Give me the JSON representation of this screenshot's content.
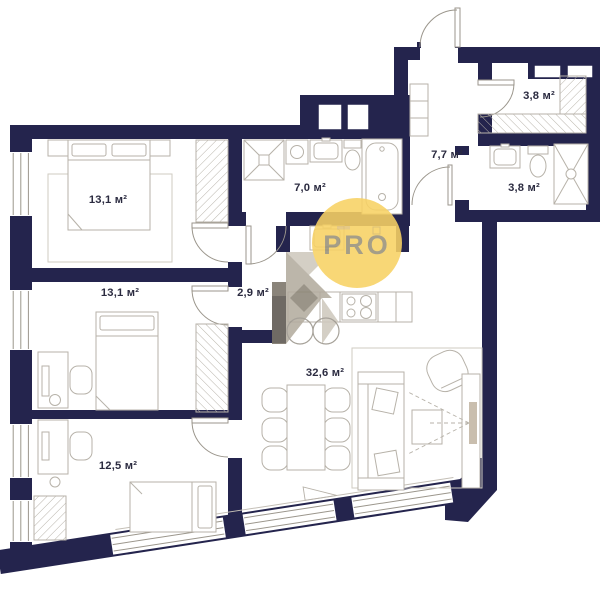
{
  "plan": {
    "type": "apartment-floor-plan",
    "units": "м²",
    "colors": {
      "wall": "#24244D",
      "furniture_line": "#B7B2A9",
      "rug_line": "#CFCBC2",
      "label_text": "#2B2B40",
      "watermark_circle": "#F8D264",
      "watermark_text": "#8F8B7B"
    },
    "watermark": {
      "brand": "PRO"
    },
    "rooms": [
      {
        "name": "bedroom-1",
        "area_label": "13,1 м²"
      },
      {
        "name": "bedroom-2",
        "area_label": "13,1 м²"
      },
      {
        "name": "bedroom-3",
        "area_label": "12,5 м²"
      },
      {
        "name": "corridor",
        "area_label": "2,9 м²"
      },
      {
        "name": "bathroom-large",
        "area_label": "7,0 м²"
      },
      {
        "name": "hallway",
        "area_label": "7,7 м²"
      },
      {
        "name": "wardrobe-room",
        "area_label": "3,8 м²"
      },
      {
        "name": "bathroom-small",
        "area_label": "3,8 м²"
      },
      {
        "name": "living-kitchen",
        "area_label": "32,6 м²"
      }
    ]
  }
}
